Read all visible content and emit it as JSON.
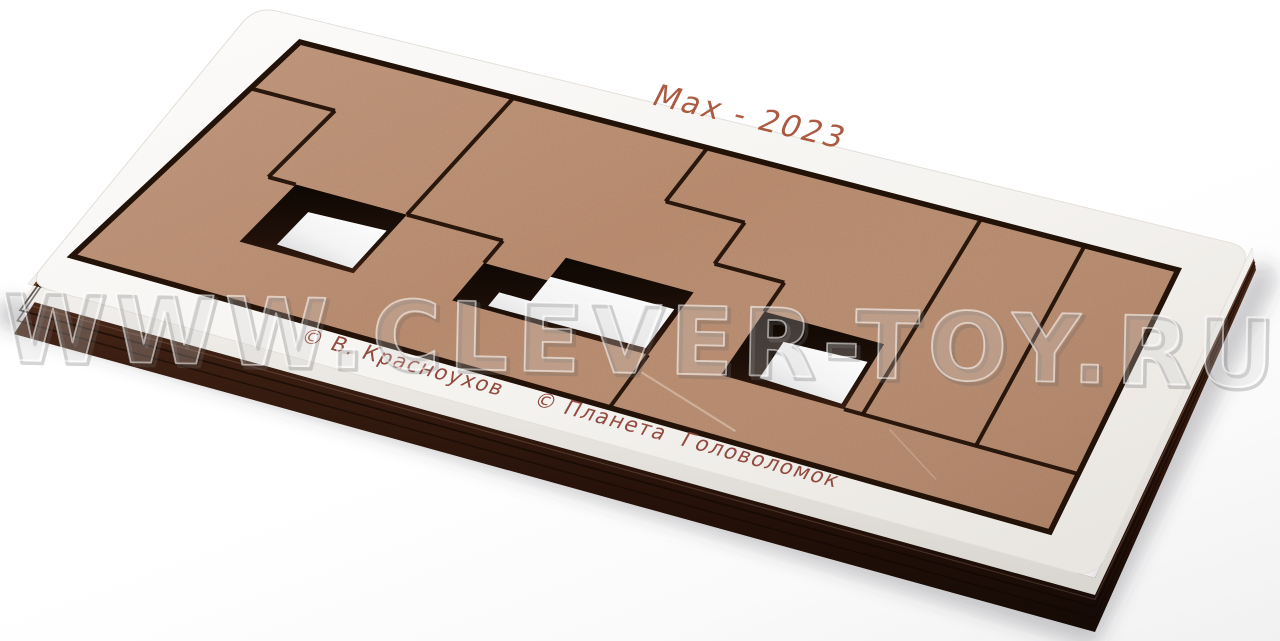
{
  "photo": {
    "description_texts": {
      "watermark": {
        "text": "WWW.CLEVER-TOY.RU",
        "color": "#9a9a9a"
      }
    },
    "watermark": {
      "text": "WWW.CLEVER-TOY.RU",
      "color": "#9a9a9a"
    },
    "tray": {
      "top_color": "#f8f6f3",
      "side_white_color": "#efece8",
      "side_dark_color": "#3c1f12",
      "engraving_top": {
        "text": "Max - 2023",
        "color": "#a4492e"
      },
      "engraving_bottom": {
        "text": "© В. Красноухов    © Планета  Головоломок",
        "color": "#8e4337"
      },
      "corners": {
        "n": [
          256,
          6
        ],
        "e": [
          1252,
          248
        ],
        "s": [
          1095,
          578
        ],
        "w": [
          28,
          284
        ]
      },
      "corner_radius": 22
    },
    "board": {
      "mdf_color": "#c08f71",
      "cut_color": "#231208",
      "grid": {
        "cols": 8,
        "rows": 4
      },
      "corners": {
        "nw": [
          300,
          42
        ],
        "ne": [
          1178,
          270
        ],
        "se": [
          1050,
          532
        ],
        "sw": [
          72,
          256
        ]
      },
      "holes": [
        {
          "name": "hole-left",
          "wall": [
            [
              1.05,
              2.2
            ],
            [
              2.05,
              2.2
            ],
            [
              2.05,
              3.2
            ],
            [
              1.05,
              3.2
            ]
          ],
          "floor": [
            [
              1.33,
              2.54
            ],
            [
              2.01,
              2.5
            ],
            [
              2.01,
              3.14
            ],
            [
              1.33,
              3.1
            ]
          ]
        },
        {
          "name": "hole-middle",
          "wall": [
            [
              2.9,
              2.58
            ],
            [
              3.45,
              2.58
            ],
            [
              3.45,
              2.2
            ],
            [
              4.55,
              2.2
            ],
            [
              4.55,
              3.2
            ],
            [
              2.9,
              3.2
            ]
          ],
          "floor": [
            [
              3.18,
              2.92
            ],
            [
              3.45,
              2.92
            ],
            [
              3.45,
              2.52
            ],
            [
              4.5,
              2.5
            ],
            [
              4.5,
              3.12
            ],
            [
              3.18,
              3.14
            ]
          ]
        },
        {
          "name": "hole-right",
          "wall": [
            [
              5.15,
              2.2
            ],
            [
              6.15,
              2.2
            ],
            [
              6.15,
              3.2
            ],
            [
              5.15,
              3.2
            ]
          ],
          "floor": [
            [
              5.43,
              2.54
            ],
            [
              6.11,
              2.5
            ],
            [
              6.11,
              3.14
            ],
            [
              5.43,
              3.1
            ]
          ]
        }
      ],
      "cuts": [
        [
          [
            0,
            0.95
          ],
          [
            0.8,
            0.95
          ]
        ],
        [
          [
            0.8,
            0.95
          ],
          [
            0.8,
            2.2
          ]
        ],
        [
          [
            0.8,
            2.2
          ],
          [
            1.05,
            2.2
          ]
        ],
        [
          [
            2.05,
            0
          ],
          [
            2.05,
            2.2
          ]
        ],
        [
          [
            2.05,
            2.2
          ],
          [
            2.9,
            2.2
          ]
        ],
        [
          [
            2.9,
            2.2
          ],
          [
            2.9,
            2.58
          ]
        ],
        [
          [
            3.85,
            0
          ],
          [
            3.85,
            1
          ]
        ],
        [
          [
            3.85,
            1
          ],
          [
            4.55,
            1
          ]
        ],
        [
          [
            4.55,
            1
          ],
          [
            4.55,
            1.72
          ]
        ],
        [
          [
            4.55,
            1.72
          ],
          [
            5.15,
            1.72
          ]
        ],
        [
          [
            5.15,
            1.72
          ],
          [
            5.15,
            2.2
          ]
        ],
        [
          [
            6.3,
            0
          ],
          [
            6.3,
            3.2
          ]
        ],
        [
          [
            7.2,
            0
          ],
          [
            7.2,
            3.2
          ]
        ],
        [
          [
            6.15,
            3.2
          ],
          [
            8,
            3.2
          ]
        ],
        [
          [
            4.55,
            3.2
          ],
          [
            4.55,
            4
          ]
        ]
      ]
    }
  }
}
